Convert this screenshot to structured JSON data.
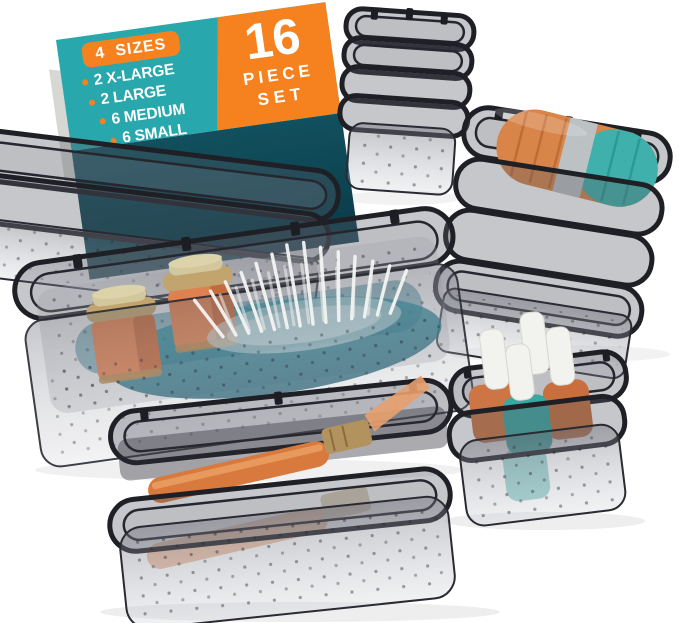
{
  "card": {
    "sizes_badge": "4 SIZES",
    "sizes": [
      "2 X-LARGE",
      "2 LARGE",
      "6 MEDIUM",
      "6 SMALL"
    ],
    "piece_count": "16",
    "piece_word": "PIECE",
    "set_word": "SET"
  },
  "colors": {
    "background": "#ffffff",
    "card_teal": "#28a7ac",
    "card_teal_dark": "#11505e",
    "card_orange": "#f5821f",
    "text_white": "#ffffff",
    "bin_smoke_rim": "#1f1f26",
    "bin_smoke_fill": "#5a5c64",
    "content_orange": "#dd8050",
    "content_gold": "#c2a46e",
    "content_teal": "#3aa8a2",
    "content_gray": "#bcc1c4",
    "cap_white": "#f2f2ef",
    "pad_teal": "#2f93a3"
  },
  "scene": {
    "bins": [
      {
        "name": "small-bin-stack-top",
        "count": 4,
        "contents": "empty"
      },
      {
        "name": "medium-bin-stack-right",
        "count": 4,
        "contents": "round jars: orange, gray, teal"
      },
      {
        "name": "large-bin-stack-left",
        "count": 2,
        "contents": "empty"
      },
      {
        "name": "xl-bin-center",
        "count": 1,
        "contents": "2 orange jars with gold lids, brush with white bristles on teal pad"
      },
      {
        "name": "medium-bin-stack-bottom",
        "count": 2,
        "contents": "orange makeup brush with gold ferrule"
      },
      {
        "name": "small-bin-stack-bottom-right",
        "count": 2,
        "contents": "4 nail polish bottles with white caps (teal and orange)"
      }
    ]
  }
}
